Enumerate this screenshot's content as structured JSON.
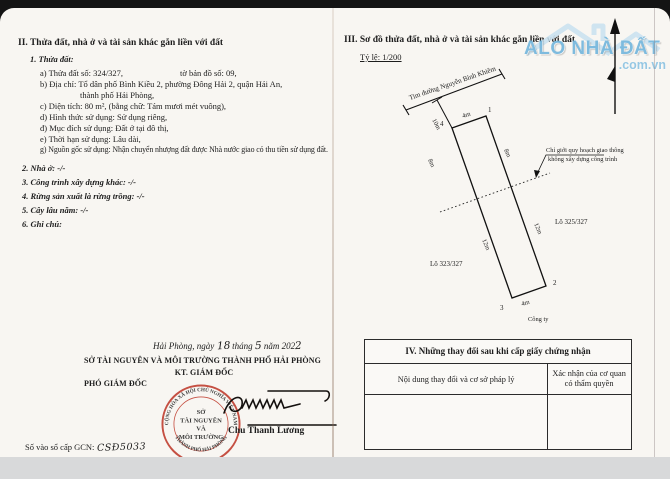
{
  "meta": {
    "brand_color": "#74b7dd",
    "stamp_color": "#bf3a2b"
  },
  "left_page": {
    "section2_title": "II. Thửa đất, nhà ở và tài sản khác gắn liền với đất",
    "subsection1": "1. Thửa đất:",
    "parcel": {
      "a_left": "a) Thửa đất số: 324/327,",
      "a_right": "tờ bản đồ số: 09,",
      "b1": "b) Địa chỉ: Tổ dân phố Bình Kiều 2, phường Đông Hải 2, quận Hải An,",
      "b2": "thành phố Hải Phòng,",
      "c": "c) Diện tích: 80 m², (bằng chữ: Tám mươi mét vuông),",
      "d": "d) Hình thức sử dụng: Sử dụng riêng,",
      "dd": "đ) Mục đích sử dụng: Đất ở tại đô thị,",
      "e": "e) Thời hạn sử dụng: Lâu dài,",
      "g": "g) Nguồn gốc sử dụng: Nhận chuyển nhượng đất được Nhà nước giao có thu tiền sử dụng đất."
    },
    "items": [
      "2. Nhà ở: -/-",
      "3. Công trình xây dựng khác: -/-",
      "4. Rừng sản xuất là rừng trồng: -/-",
      "5. Cây lâu năm: -/-",
      "6. Ghi chú:"
    ],
    "date_line": {
      "p1": "Hải Phòng, ngày",
      "day": "18",
      "p2": "tháng",
      "month": "5",
      "p3": "năm 202",
      "year_last": "2"
    },
    "authority": "SỞ TÀI NGUYÊN VÀ MÔI TRƯỜNG THÀNH PHỐ HẢI PHÒNG",
    "kt": "KT. GIÁM ĐỐC",
    "deputy": "PHÓ GIÁM ĐỐC",
    "signer_name": "Chu Thanh Lương",
    "stamp": {
      "ring_top": "CỘNG HÒA XÃ HỘI CHỦ NGHĨA VIỆT NAM",
      "ring_bottom": "THÀNH PHỐ HẢI PHÒNG",
      "line1": "SỞ",
      "line2": "TÀI NGUYÊN",
      "line3": "VÀ",
      "line4": "MÔI TRƯỜNG"
    },
    "book_no_label": "Số vào sổ cấp GCN:",
    "book_no_value": "CSĐ5033"
  },
  "right_page": {
    "section3_title": "III. Sơ đồ thửa đất, nhà ở và tài sản khác gắn liền với đất",
    "scale_label": "Tỷ lệ: 1/200",
    "watermark": {
      "brand": "ALO NHÀ ĐẤT",
      "domain": ".com.vn"
    },
    "diagram": {
      "street": "Tim đường Nguyễn Bỉnh Khiêm",
      "offset_dim": "10m",
      "front_dim": "4m",
      "back_dim": "4m",
      "left_upper_dim": "8m",
      "right_upper_dim": "8m",
      "left_lower_dim": "12m",
      "right_lower_dim": "12m",
      "corner_1": "1",
      "corner_2": "2",
      "corner_3": "3",
      "corner_4": "4",
      "note_line1": "Chỉ giới quy hoạch giao thông",
      "note_line2": "không xây dựng công trình",
      "lot_right": "Lô 325/327",
      "lot_left": "Lô 323/327",
      "company": "Công ty"
    },
    "section4": {
      "title": "IV. Những thay đổi sau khi cấp giấy chứng nhận",
      "col1": "Nội dung thay đổi và cơ sở pháp lý",
      "col2_line1": "Xác nhận của cơ quan",
      "col2_line2": "có thẩm quyền"
    }
  }
}
